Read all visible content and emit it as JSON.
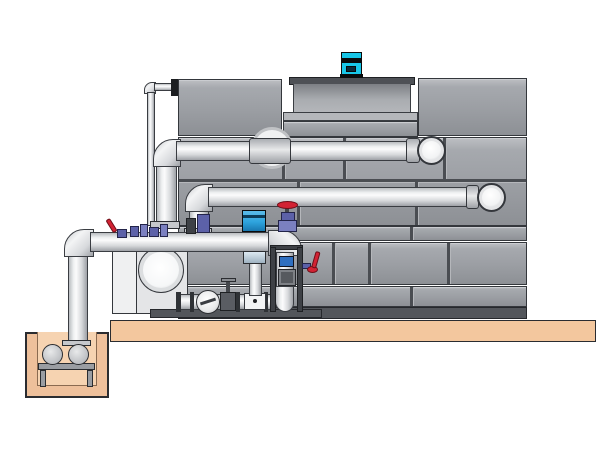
{
  "diagram": {
    "kind": "cooling-tower-installation-illustration",
    "components": {
      "cooling_tower": "Cooling tower casing",
      "fan_motor": "Fan motor",
      "fan_shroud": "Fan shroud",
      "access_port": "Circular access port",
      "hot_water_pipe": "Upper horizontal pipe into tower",
      "return_pipe": "Lower horizontal pipe into tower",
      "chemical_feed_line": "Thin feed line",
      "sump_discharge_pipe": "Sump pump discharge pipe",
      "suction_manifold": "Pump suction manifold",
      "check_valve": "Wafer check valve",
      "gate_valve": "Gate valve",
      "red_gate_valve": "Gate valve with red handwheel",
      "red_lever_valve": "Butterfly valve with red lever",
      "volute_pump": "End-suction centrifugal pump",
      "vertical_pump": "Vertical inline pump with blue motor",
      "distribution_frame": "Pipe support frame",
      "concrete_slab": "Concrete equipment slab",
      "sump_pit": "Concrete sump pit",
      "sump_pump": "Sump pump",
      "pump_stand": "Sump pump stand"
    },
    "colors": {
      "bg": "#ffffff",
      "tower_panel": "#9b9ea3",
      "tower_base": "#53565b",
      "shroud_rim": "#4e5156",
      "pipe_light": "#fbfbfc",
      "slab_tan": "#f3c79e",
      "pit_wall": "#eec09b",
      "pit_inner": "#f6d3b1",
      "metal_gray": "#c6c8cc",
      "motor_cyan": "#18c6e8",
      "pump_blue": "#2ea4de",
      "valve_red": "#d22233",
      "fitting_purple": "#5c61a8",
      "fitting_purple_light": "#7b80c0",
      "fitting_blue": "#2f6fc0"
    }
  }
}
